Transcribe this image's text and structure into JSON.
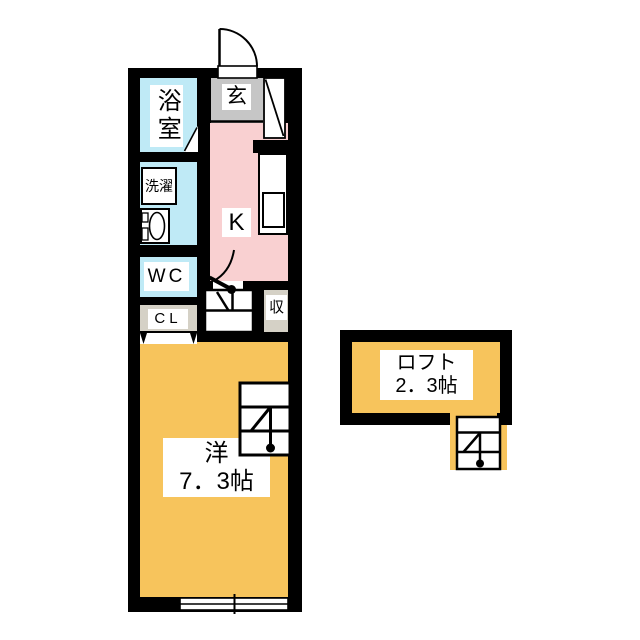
{
  "title": "apartment floor plan",
  "rooms": {
    "bathroom": {
      "label": "浴室"
    },
    "entrance": {
      "label": "玄"
    },
    "laundry": {
      "label": "洗濯"
    },
    "toilet": {
      "label": "WC"
    },
    "closet": {
      "label": "CL"
    },
    "kitchen": {
      "label": "K"
    },
    "storage": {
      "label": "収"
    },
    "main_room": {
      "label": "洋",
      "size": "7．3帖"
    },
    "loft": {
      "label": "ロフト",
      "size": "2．3帖"
    }
  },
  "symbols": [
    "entrance-door-arc",
    "shoe-cabinet-diagonal",
    "bathroom-door-diagonal",
    "washbasin-ellipse",
    "kitchen-sink",
    "kitchen-door-arc",
    "hall-step-icon",
    "closet-folding-door-triangles",
    "ladder-to-loft-icon",
    "loft-ladder-icon",
    "sliding-window-icon"
  ],
  "colors": {
    "wall": "#000000",
    "water": "#bfeaf6",
    "kitchen": "#f9d0d1",
    "room": "#f7c45c",
    "genkan": "#c6c6c6",
    "closet": "#d5d1c6",
    "white": "#ffffff"
  }
}
